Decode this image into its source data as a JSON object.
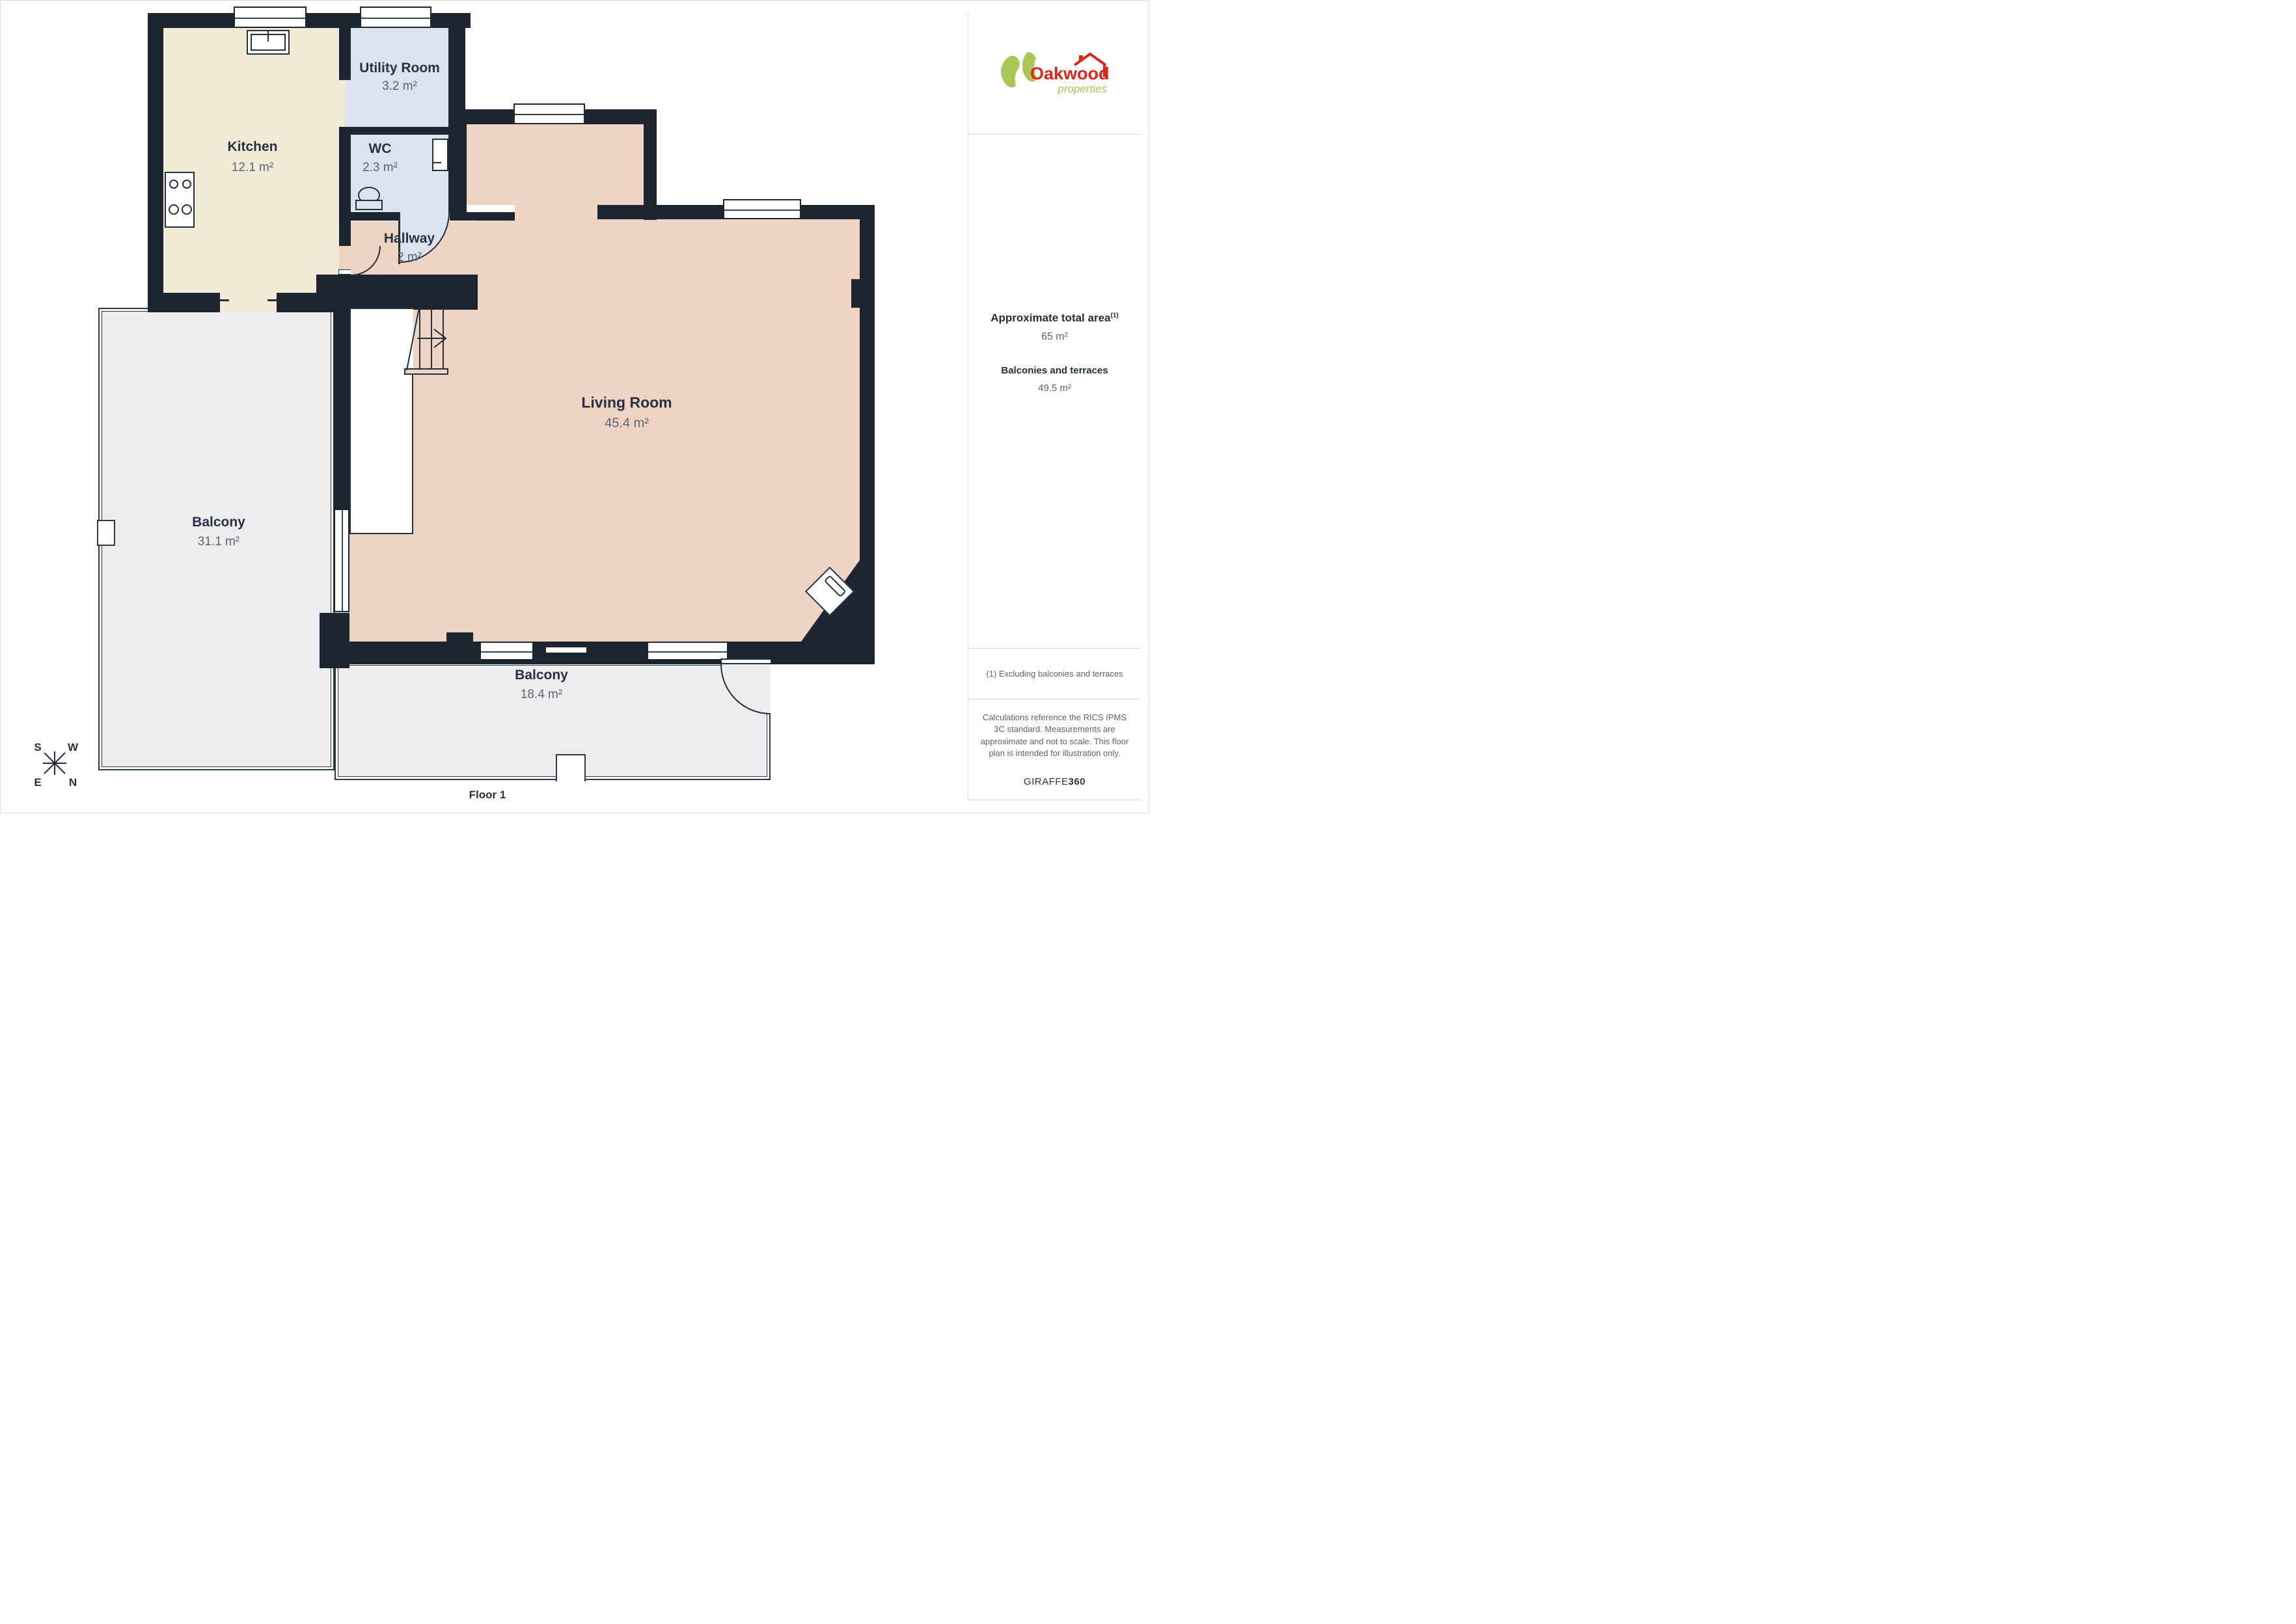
{
  "floor": {
    "label": "Floor 1"
  },
  "logo": {
    "name": "Oakwood",
    "tagline": "properties",
    "red": "#e1251b",
    "green": "#a9c656"
  },
  "rooms": {
    "kitchen": {
      "name": "Kitchen",
      "area": "12.1 m²"
    },
    "utility": {
      "name": "Utility Room",
      "area": "3.2 m²"
    },
    "wc": {
      "name": "WC",
      "area": "2.3 m²"
    },
    "hallway": {
      "name": "Hallway",
      "area": "2 m²"
    },
    "living": {
      "name": "Living Room",
      "area": "45.4 m²"
    },
    "balcony_left": {
      "name": "Balcony",
      "area": "31.1 m²"
    },
    "balcony_bottom": {
      "name": "Balcony",
      "area": "18.4 m²"
    }
  },
  "sidebar": {
    "total_title": "Approximate total area",
    "total_marker": "(1)",
    "total_value": "65 m²",
    "balconies_title": "Balconies and terraces",
    "balconies_value": "49.5 m²",
    "note": "(1) Excluding balconies and terraces",
    "disclaimer": "Calculations reference the RICS IPMS 3C standard. Measurements are approximate and not to scale. This floor plan is intended for illustration only.",
    "brand_regular": "GIRAFFE",
    "brand_bold": "360"
  },
  "compass": {
    "s": "S",
    "w": "W",
    "e": "E",
    "n": "N"
  },
  "colors": {
    "wall": "#1d2531",
    "kitchen_fill": "#f1ead6",
    "wet_fill": "#dde2ef",
    "living_fill": "#efd4c4",
    "balcony_fill": "#ededef",
    "label": "#273142",
    "area_text": "#5a6472"
  }
}
